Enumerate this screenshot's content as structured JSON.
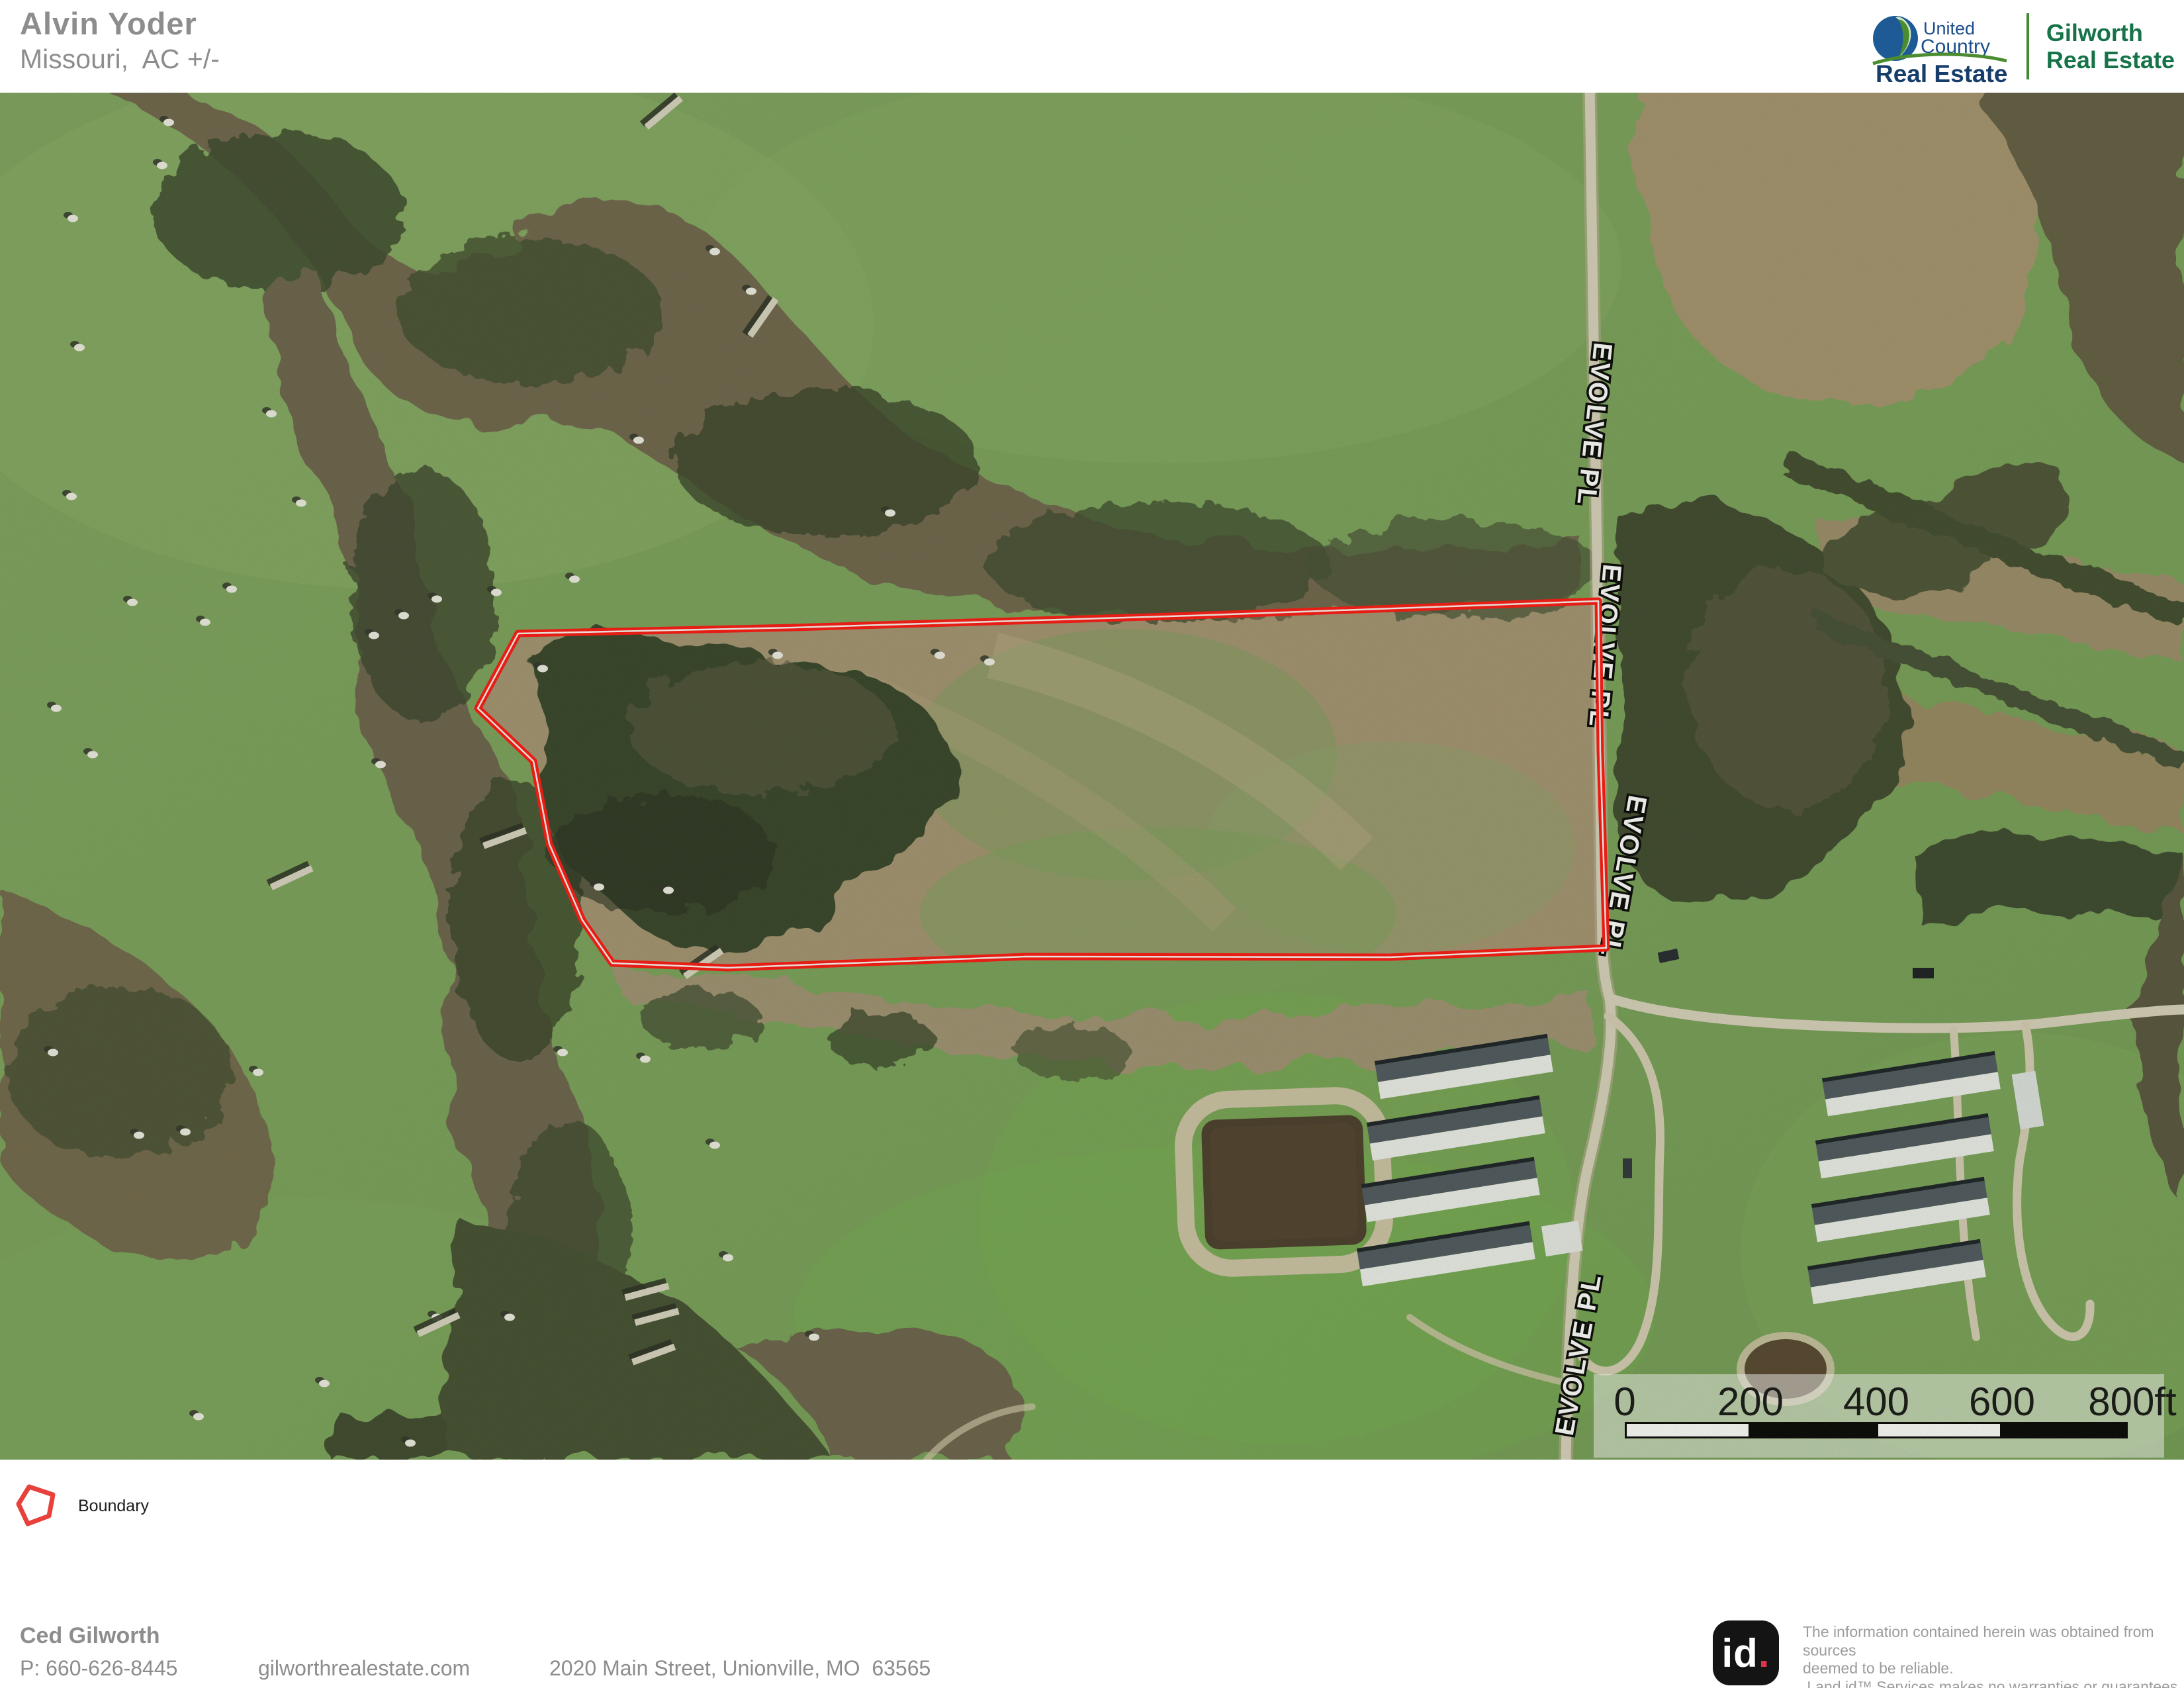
{
  "header": {
    "title": "Alvin Yoder",
    "subtitle": "Missouri,  AC +/-"
  },
  "brand": {
    "uc_word1": "United",
    "uc_word2": "Country",
    "uc_word3": "Real Estate",
    "partner_line1": "Gilworth",
    "partner_line2": "Real Estate"
  },
  "map": {
    "road_label": "EVOLVE PL",
    "scale": {
      "labels": [
        "0",
        "200",
        "400",
        "600",
        "800ft"
      ]
    },
    "hay_bales": [
      [
        255,
        45
      ],
      [
        110,
        190
      ],
      [
        245,
        110
      ],
      [
        120,
        385
      ],
      [
        108,
        610
      ],
      [
        410,
        485
      ],
      [
        455,
        620
      ],
      [
        350,
        750
      ],
      [
        200,
        770
      ],
      [
        310,
        800
      ],
      [
        610,
        790
      ],
      [
        660,
        765
      ],
      [
        750,
        755
      ],
      [
        868,
        735
      ],
      [
        820,
        870
      ],
      [
        565,
        820
      ],
      [
        575,
        1015
      ],
      [
        85,
        930
      ],
      [
        140,
        1000
      ],
      [
        1080,
        240
      ],
      [
        1135,
        300
      ],
      [
        965,
        525
      ],
      [
        1175,
        850
      ],
      [
        1420,
        850
      ],
      [
        80,
        1450
      ],
      [
        390,
        1480
      ],
      [
        280,
        1570
      ],
      [
        210,
        1575
      ],
      [
        850,
        1450
      ],
      [
        975,
        1460
      ],
      [
        1080,
        1590
      ],
      [
        1100,
        1760
      ],
      [
        770,
        1850
      ],
      [
        660,
        1850
      ],
      [
        490,
        1950
      ],
      [
        300,
        2000
      ],
      [
        620,
        2040
      ],
      [
        1230,
        1880
      ],
      [
        905,
        1200
      ],
      [
        1010,
        1205
      ],
      [
        1345,
        635
      ],
      [
        1495,
        860
      ]
    ],
    "windrows": [
      [
        1000,
        30,
        -40
      ],
      [
        1150,
        340,
        -55
      ],
      [
        438,
        1185,
        -25
      ],
      [
        760,
        1125,
        -20
      ],
      [
        975,
        1810,
        -15
      ],
      [
        990,
        1848,
        -15
      ],
      [
        985,
        1905,
        -20
      ],
      [
        660,
        1860,
        -25
      ],
      [
        1060,
        1315,
        -35
      ]
    ]
  },
  "legend": {
    "boundary_label": "Boundary"
  },
  "footer": {
    "agent_name": "Ced Gilworth",
    "phone": "P: 660-626-8445",
    "website": "gilworthrealestate.com",
    "address": "2020 Main Street, Unionville, MO  63565"
  },
  "attribution": {
    "logo_text": "id",
    "logo_dot": ".",
    "disclaimer_lines": [
      "The information contained herein was obtained from sources",
      "deemed to be reliable.",
      " Land id™ Services makes no warranties or guarantees as to the",
      "completeness or accuracy thereof."
    ]
  },
  "colors": {
    "boundary": "#ff120d",
    "brand_blue": "#1c4f8c",
    "brand_navy": "#173e6b",
    "brand_green": "#3f8a2e",
    "partner_green": "#157347",
    "header_gray": "#8d8d8d"
  }
}
